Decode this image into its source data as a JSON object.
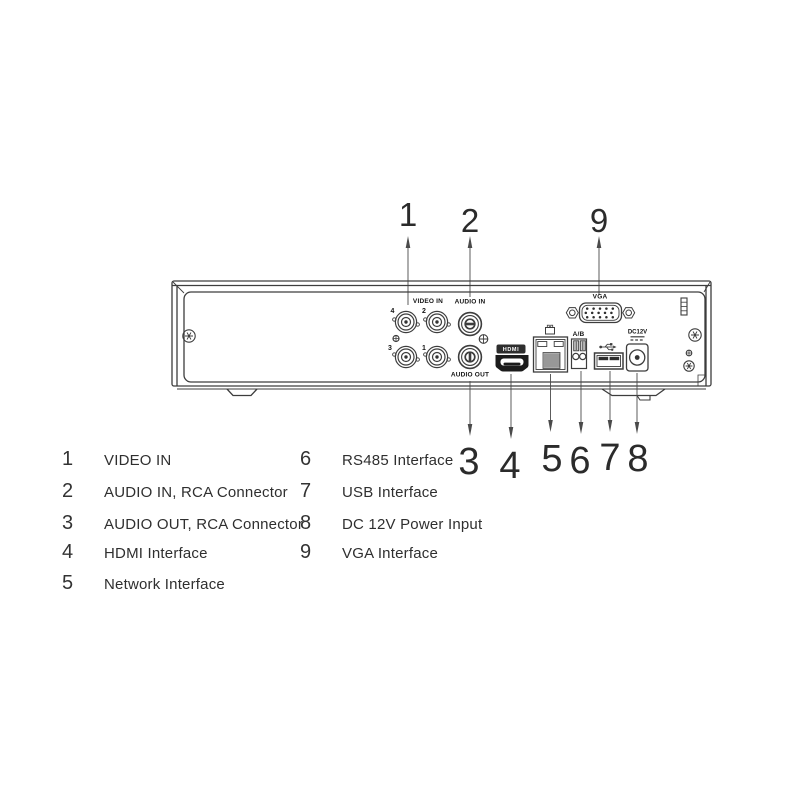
{
  "diagram": {
    "type": "device-rear-panel",
    "colors": {
      "background": "#ffffff",
      "line": "#3d3d3d",
      "text": "#2f2f2f",
      "port_fill": "#1c1c1c"
    }
  },
  "panel_labels": {
    "video_in": "VIDEO IN",
    "audio_in": "AUDIO IN",
    "audio_out": "AUDIO OUT",
    "hdmi_badge": "HDMI",
    "vga": "VGA",
    "rs485": "A/B",
    "dc12v": "DC12V",
    "bnc_numbers": [
      "4",
      "2",
      "3",
      "1"
    ]
  },
  "callouts": {
    "top": [
      {
        "num": "1"
      },
      {
        "num": "2"
      },
      {
        "num": "9"
      }
    ],
    "bottom": [
      {
        "num": "3"
      },
      {
        "num": "4"
      },
      {
        "num": "5"
      },
      {
        "num": "6"
      },
      {
        "num": "7"
      },
      {
        "num": "8"
      }
    ]
  },
  "legend": {
    "left": [
      {
        "num": "1",
        "label": "VIDEO IN"
      },
      {
        "num": "2",
        "label": "AUDIO IN, RCA Connector"
      },
      {
        "num": "3",
        "label": "AUDIO OUT, RCA Connector"
      },
      {
        "num": "4",
        "label": "HDMI Interface"
      },
      {
        "num": "5",
        "label": "Network Interface"
      }
    ],
    "right": [
      {
        "num": "6",
        "label": "RS485 Interface"
      },
      {
        "num": "7",
        "label": "USB Interface"
      },
      {
        "num": "8",
        "label": "DC 12V Power Input"
      },
      {
        "num": "9",
        "label": "VGA Interface"
      }
    ]
  }
}
